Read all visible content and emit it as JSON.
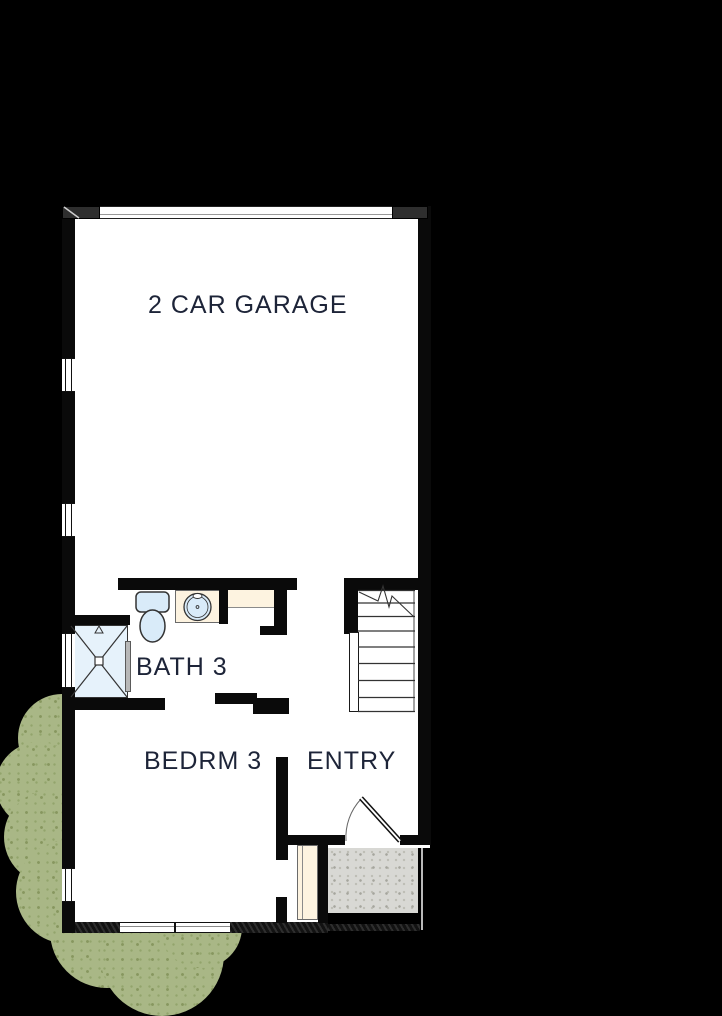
{
  "plan": {
    "type": "residential-floor-plan",
    "rooms": {
      "garage": {
        "label": "2 CAR GARAGE"
      },
      "bath": {
        "label": "BATH 3"
      },
      "bedroom": {
        "label": "BEDRM 3"
      },
      "entry": {
        "label": "ENTRY"
      }
    },
    "symbols": [
      "garage-door",
      "window",
      "shower",
      "toilet",
      "sink-vanity",
      "closet-shelf",
      "stairs-up",
      "entry-door-swing",
      "closet-door",
      "porch-slab",
      "shrubs"
    ],
    "colors": {
      "background": "#000000",
      "wall": "#0a0a0a",
      "floor": "#ffffff",
      "fixture_blue": "#d9ebf9",
      "shower_blue": "#e6f2fb",
      "counter_beige": "#fdf3e0",
      "porch_gray": "#d8d8d4",
      "shrub_green": "#a9b786",
      "label_text": "#1d2438"
    }
  }
}
